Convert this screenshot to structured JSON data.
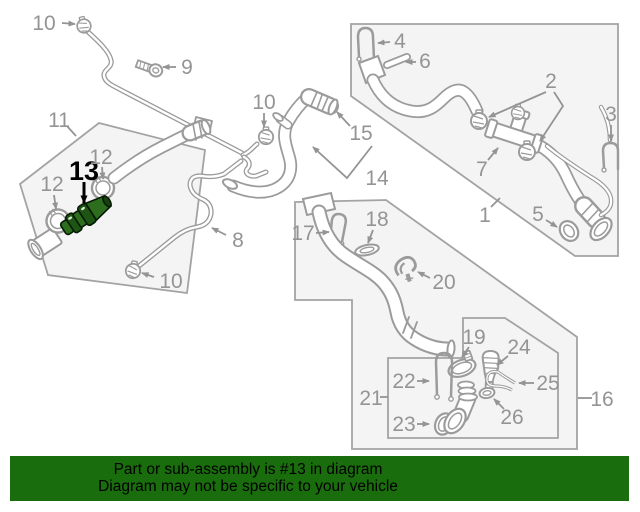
{
  "diagram": {
    "highlighted_part": "13",
    "callouts": [
      {
        "id": "10-top-left",
        "label": "10"
      },
      {
        "id": "9",
        "label": "9"
      },
      {
        "id": "11",
        "label": "11"
      },
      {
        "id": "12-left",
        "label": "12"
      },
      {
        "id": "13-highlighted",
        "label": "13"
      },
      {
        "id": "12-right",
        "label": "12"
      },
      {
        "id": "15",
        "label": "15"
      },
      {
        "id": "14",
        "label": "14"
      },
      {
        "id": "10-middle",
        "label": "10"
      },
      {
        "id": "8",
        "label": "8"
      },
      {
        "id": "10-bottom",
        "label": "10"
      },
      {
        "id": "17",
        "label": "17"
      },
      {
        "id": "18",
        "label": "18"
      },
      {
        "id": "20",
        "label": "20"
      },
      {
        "id": "19",
        "label": "19"
      },
      {
        "id": "24",
        "label": "24"
      },
      {
        "id": "22",
        "label": "22"
      },
      {
        "id": "25",
        "label": "25"
      },
      {
        "id": "26",
        "label": "26"
      },
      {
        "id": "23",
        "label": "23"
      },
      {
        "id": "21",
        "label": "21"
      },
      {
        "id": "16",
        "label": "16"
      },
      {
        "id": "1",
        "label": "1"
      },
      {
        "id": "4",
        "label": "4"
      },
      {
        "id": "6",
        "label": "6"
      },
      {
        "id": "2",
        "label": "2"
      },
      {
        "id": "3",
        "label": "3"
      },
      {
        "id": "7",
        "label": "7"
      },
      {
        "id": "5",
        "label": "5"
      }
    ],
    "colors": {
      "line_gray": "#9b9b9b",
      "label_gray": "#949494",
      "panel_fill": "#f4f4f4",
      "panel_border": "#a3a3a3",
      "highlight_fill": "#2c6e1e",
      "highlight_fill_dark": "#1e5414",
      "highlight_stroke": "#061a04"
    }
  },
  "banner": {
    "line1": "Part or sub-assembly is #13 in diagram",
    "line2": "Diagram may not be specific to your vehicle",
    "background": "#1a6d0c",
    "text_color": "#000000"
  }
}
